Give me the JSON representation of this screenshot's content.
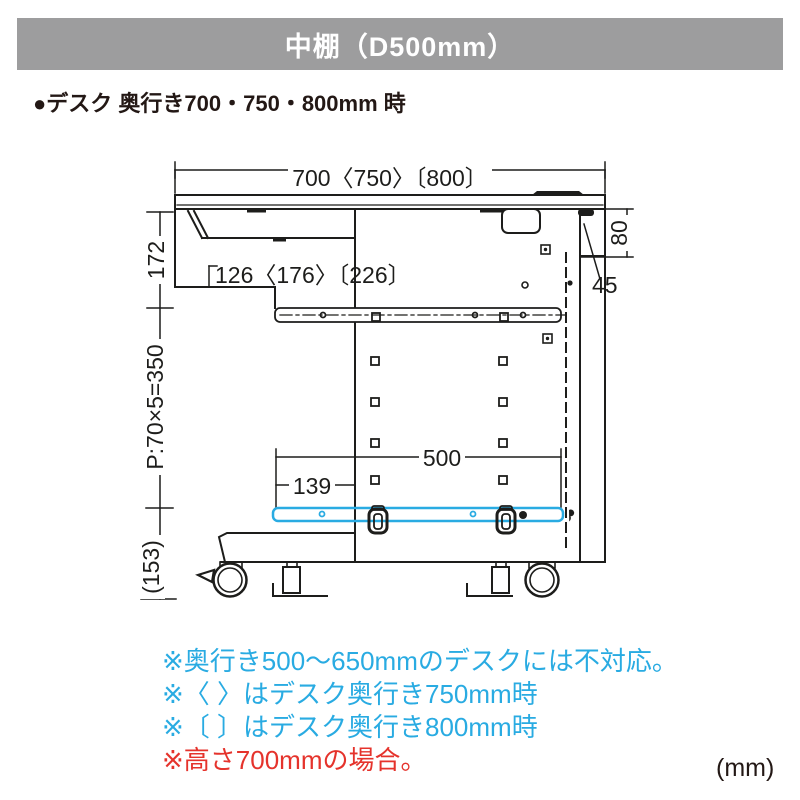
{
  "header": {
    "title": "中棚（D500mm）"
  },
  "subtitle": "●デスク 奥行き700・750・800mm 時",
  "diagram": {
    "description": "desk-side-view-with-middle-shelf",
    "dimensions": {
      "top_width": "700〈750〉〔800〕",
      "shelf_setback": "126〈176〉〔226〕",
      "under_top_height": "172",
      "hole_pitch": "P:70×5=350",
      "bottom_clearance": "(153)",
      "back_top_height": "80",
      "back_panel_depth": "45",
      "shelf_depth": "500",
      "shelf_front_offset": "139"
    },
    "colors": {
      "line": "#1d1d1b",
      "shelf_highlight": "#29abe2",
      "header_gray": "#9d9d9e"
    }
  },
  "notes": [
    {
      "text": "※奥行き500〜650mmのデスクには不対応。",
      "color": "#29abe2"
    },
    {
      "text": "※〈 〉はデスク奥行き750mm時",
      "color": "#29abe2"
    },
    {
      "text": "※〔 〕はデスク奥行き800mm時",
      "color": "#29abe2"
    },
    {
      "text": "※高さ700mmの場合。",
      "color": "#e5332c"
    }
  ],
  "unit_label": "(mm)"
}
